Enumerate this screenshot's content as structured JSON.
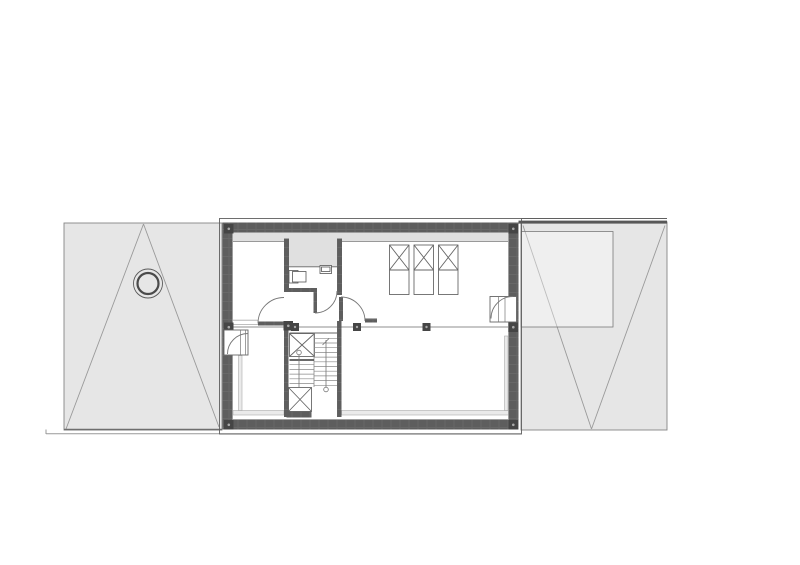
{
  "drawing": {
    "kind": "architectural-floor-plan",
    "storey": "attic-level-with-roof-planes"
  },
  "colors": {
    "paper": "#ffffff",
    "wall_base": "#5e5e5e",
    "wall_streak": "#6c6c6c",
    "post": "#454545",
    "post_dot": "#a9a9a9",
    "roof": "#e6e6e6",
    "roof_edge": "#858585",
    "valley": "#9a9a9a",
    "zone": "#e0e0e0",
    "ledge": "#eaeaea",
    "line": "#666666",
    "thin": "#8f8f8f",
    "arc": "#777777",
    "fixture": "#555555",
    "ground": "#999999",
    "outline": "#5f5f5f",
    "dormer_top": "#585858"
  },
  "inventory": {
    "roof_plane_blocks": 2,
    "chimney_count": 1,
    "skylight_count": 3,
    "structural_post_count": 9,
    "wall_post_count": 6,
    "stair_flight_count": 2,
    "stair_void_boxes": 2,
    "interior_door_count": 3,
    "exterior_opening_count": 2,
    "bathroom_fixture_count": 2
  }
}
